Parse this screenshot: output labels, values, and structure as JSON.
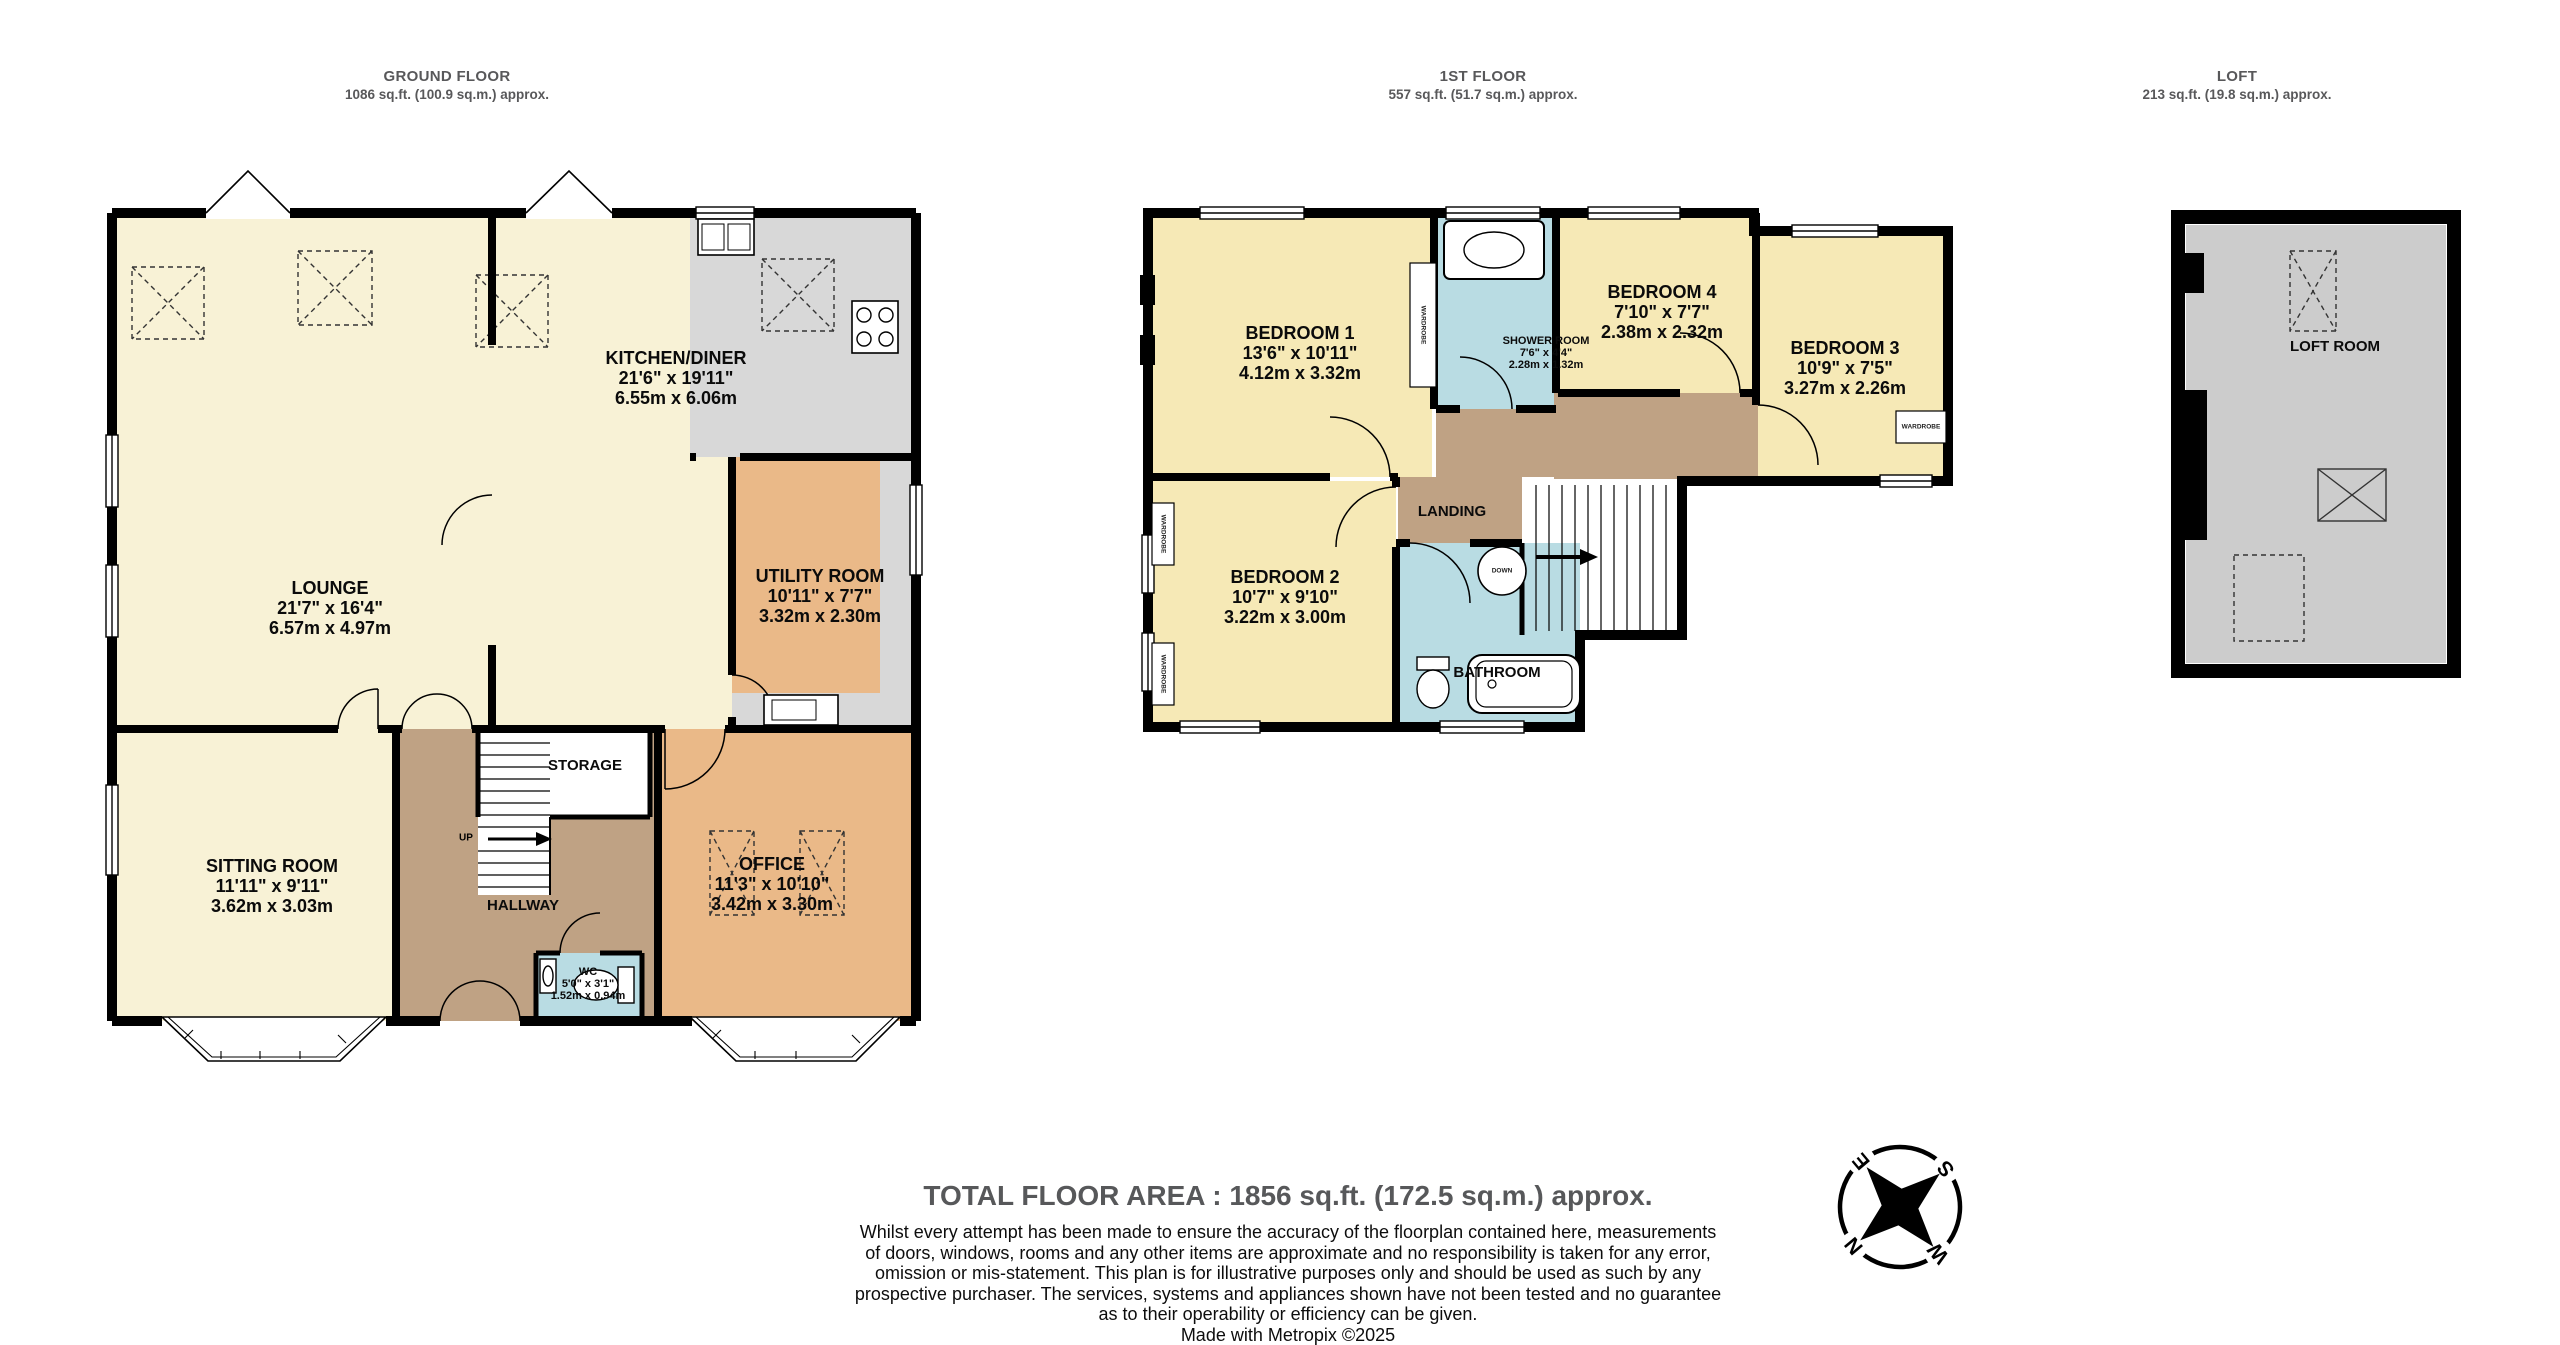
{
  "floors": {
    "ground": {
      "title": "GROUND FLOOR",
      "subtitle": "1086 sq.ft. (100.9 sq.m.) approx."
    },
    "first": {
      "title": "1ST FLOOR",
      "subtitle": "557 sq.ft. (51.7 sq.m.) approx."
    },
    "loft": {
      "title": "LOFT",
      "subtitle": "213 sq.ft. (19.8 sq.m.) approx."
    }
  },
  "rooms": {
    "lounge": {
      "name": "LOUNGE",
      "imperial": "21'7\" x 16'4\"",
      "metric": "6.57m x 4.97m"
    },
    "kitchen": {
      "name": "KITCHEN/DINER",
      "imperial": "21'6\" x 19'11\"",
      "metric": "6.55m x 6.06m"
    },
    "utility": {
      "name": "UTILITY ROOM",
      "imperial": "10'11\" x 7'7\"",
      "metric": "3.32m x 2.30m"
    },
    "sitting": {
      "name": "SITTING ROOM",
      "imperial": "11'11\" x 9'11\"",
      "metric": "3.62m x 3.03m"
    },
    "storage": {
      "name": "STORAGE"
    },
    "hallway": {
      "name": "HALLWAY"
    },
    "office": {
      "name": "OFFICE",
      "imperial": "11'3\" x 10'10\"",
      "metric": "3.42m x 3.30m"
    },
    "wc": {
      "name": "WC",
      "imperial": "5'0\" x 3'1\"",
      "metric": "1.52m x 0.94m"
    },
    "bedroom1": {
      "name": "BEDROOM 1",
      "imperial": "13'6\" x 10'11\"",
      "metric": "4.12m x 3.32m"
    },
    "bedroom2": {
      "name": "BEDROOM 2",
      "imperial": "10'7\" x 9'10\"",
      "metric": "3.22m x 3.00m"
    },
    "bedroom3": {
      "name": "BEDROOM 3",
      "imperial": "10'9\" x 7'5\"",
      "metric": "3.27m x 2.26m"
    },
    "bedroom4": {
      "name": "BEDROOM 4",
      "imperial": "7'10\" x 7'7\"",
      "metric": "2.38m x 2.32m"
    },
    "shower": {
      "name": "SHOWER ROOM",
      "imperial": "7'6\" x 4'4\"",
      "metric": "2.28m x 1.32m"
    },
    "landing": {
      "name": "LANDING"
    },
    "bathroom": {
      "name": "BATHROOM"
    },
    "loftroom": {
      "name": "LOFT ROOM"
    }
  },
  "annotations": {
    "up": "UP",
    "down": "DOWN",
    "wardrobe": "WARDROBE"
  },
  "compass": {
    "n": "N",
    "e": "E",
    "s": "S",
    "w": "W"
  },
  "footer": {
    "total": "TOTAL FLOOR AREA : 1856 sq.ft. (172.5 sq.m.) approx.",
    "disclaimer_lines": [
      "Whilst every attempt has been made to ensure the accuracy of the floorplan contained here, measurements",
      "of doors, windows, rooms and any other items are approximate and no responsibility is taken for any error,",
      "omission or mis-statement. This plan is for illustrative purposes only and should be used as such by any",
      "prospective purchaser. The services, systems and appliances shown have not been tested and no guarantee",
      "as to their operability or efficiency can be given.",
      "Made with Metropix ©2025"
    ]
  },
  "colors": {
    "wall": "#000000",
    "cream_room": "#f8f2d6",
    "bedroom_yellow": "#f6e9b6",
    "orange_room": "#eab988",
    "hall_brown": "#bfa284",
    "wet_room_blue": "#b9dce3",
    "kitchen_gray": "#d8d8d8",
    "loft_gray": "#cccccc",
    "heading_gray": "#58585a"
  }
}
